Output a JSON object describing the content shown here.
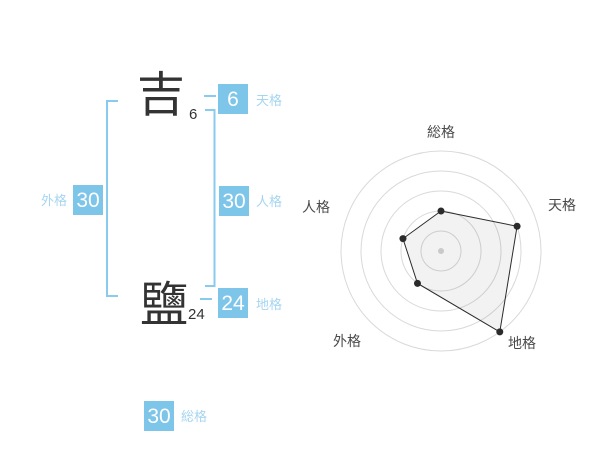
{
  "colors": {
    "box-blue": "#7ec5ea",
    "label-blue": "#a6d5f1",
    "bracket-blue": "#89cbee",
    "ink": "#333333",
    "radar-label": "#4a4a4a",
    "ring-gray": "#d9d9d9",
    "center-dot-gray": "#c9c9c9",
    "polygon-stroke": "#2b2b2b",
    "polygon-fill": "rgba(0,0,0,0.05)"
  },
  "name": {
    "surname_char": "吉",
    "surname_strokes": "6",
    "given_char": "鹽",
    "given_strokes": "24"
  },
  "kaku": {
    "tenkaku": {
      "label": "天格",
      "value": "6"
    },
    "jinkaku": {
      "label": "人格",
      "value": "30"
    },
    "chikaku": {
      "label": "地格",
      "value": "24"
    },
    "gaikaku": {
      "label": "外格",
      "value": "30"
    },
    "soukaku": {
      "label": "総格",
      "value": "30"
    }
  },
  "chart_data": {
    "type": "radar",
    "categories": [
      "総格",
      "天格",
      "地格",
      "外格",
      "人格"
    ],
    "values": [
      2,
      4,
      5,
      2,
      2
    ],
    "max": 5,
    "rings": 5,
    "ring_unit_px": 20,
    "start_angle_deg": 90,
    "direction": "clockwise",
    "legend": "none",
    "grid": "circular"
  }
}
